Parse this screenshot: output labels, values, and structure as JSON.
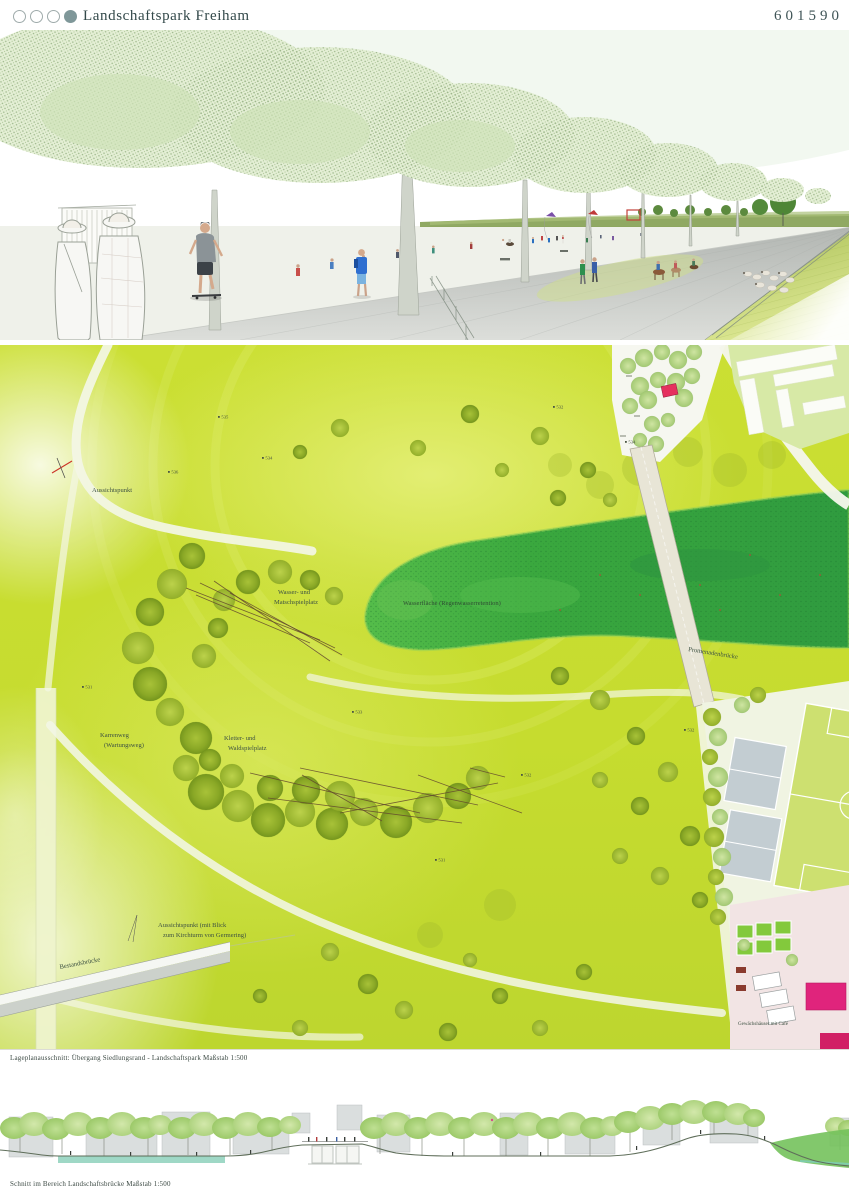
{
  "header": {
    "title": "Landschaftspark Freiham",
    "entry_number": "601590",
    "category_dots": {
      "total": 4,
      "filled_position": 4
    }
  },
  "perspective": {
    "description": "promenade-with-meadow-rendering"
  },
  "plan": {
    "labels": {
      "aussichtspunkt": "Aussichtspunkt",
      "wasserspielplatz_line1": "Wasser- und",
      "wasserspielplatz_line2": "Matschspielplatz",
      "wasserflaeche": "Wasserfläche (Regenwasserretention)",
      "wartungsweg_line1": "Karrenweg",
      "wartungsweg_line2": "(Wartungsweg)",
      "kletter_line1": "Kletter- und",
      "kletter_line2": "Waldspielplatz",
      "aussicht_blick_line1": "Aussichtspunkt (mit Blick",
      "aussicht_blick_line2": "zum Kirchturm von Germering)",
      "promenadenbruecke": "Promenadenbrücke",
      "bestandsbruecke": "Bestandsbrücke",
      "gewaechshaeuser": "Gewächshäuser mit Café"
    },
    "spot_elevations": [
      "536",
      "535",
      "534",
      "532",
      "534",
      "531",
      "532",
      "533",
      "532",
      "531"
    ],
    "caption": "Lageplanausschnitt: Übergang Siedlungsrand - Landschaftspark Maßstab 1:500"
  },
  "section": {
    "caption": "Schnitt im Bereich Landschaftsbrücke Maßstab 1:500"
  },
  "colors": {
    "text_dark": "#33494a",
    "dot_teal": "#7f9799",
    "field_chartreuse": "#c8dd32",
    "water_green": "#39a33f",
    "tree_olive": "#8fa826",
    "accent_magenta": "#e0247c",
    "pavilion_red": "#e5305e",
    "court_gray": "#c3cdd2",
    "section_water_teal": "#8ed1bc"
  }
}
